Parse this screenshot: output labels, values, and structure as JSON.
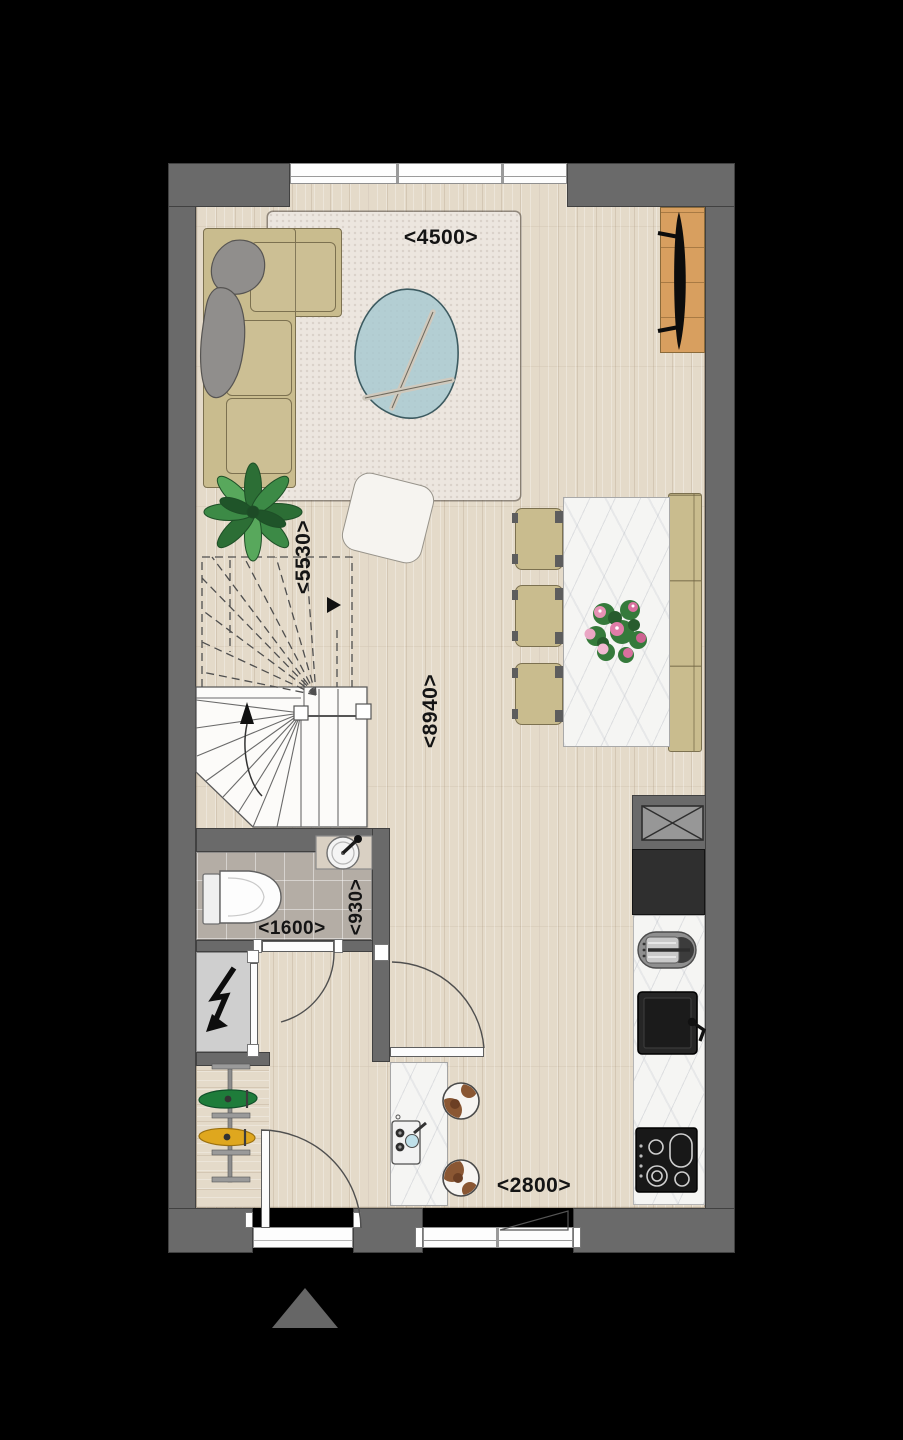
{
  "plan": {
    "dimension_labels": {
      "living_width": "<4500>",
      "stair_zone_depth": "<5530>",
      "room_depth": "<8940>",
      "toilet_width": "<1600>",
      "toilet_depth": "<930>",
      "kitchen_zone_width": "<2800>"
    },
    "symbols": {
      "meter_cupboard": "lightning-bolt",
      "entrance_marker": "triangle-up",
      "stairs_direction_up": "arrow-up",
      "stairs_above_direction": "arrow-right",
      "window_opening_direction": "triangle",
      "ventilation_shaft": "crossed-box"
    },
    "colors": {
      "background": "#000000",
      "wall": "#6a6a6a",
      "wall-outline": "#414141",
      "floor-wood": "#e4dac9",
      "floor-tile": "#b4ada5",
      "closet-floor": "#cfcfcf",
      "rug": "#ece6df",
      "marble": "#f5f5f3",
      "sofa": "#c9bc8e",
      "sofa-outline": "#7c7150",
      "glass": "#a6c8d1",
      "tv-wood": "#d89f5f",
      "label": "#141414",
      "plant-green": "#2f7439",
      "bouquet-pink": "#e07ca8",
      "bike-green": "#1e7c3a",
      "bike-yellow": "#dfa71e",
      "stool-brown": "#8a5733",
      "appliance-dark": "#1d1d1d"
    }
  }
}
